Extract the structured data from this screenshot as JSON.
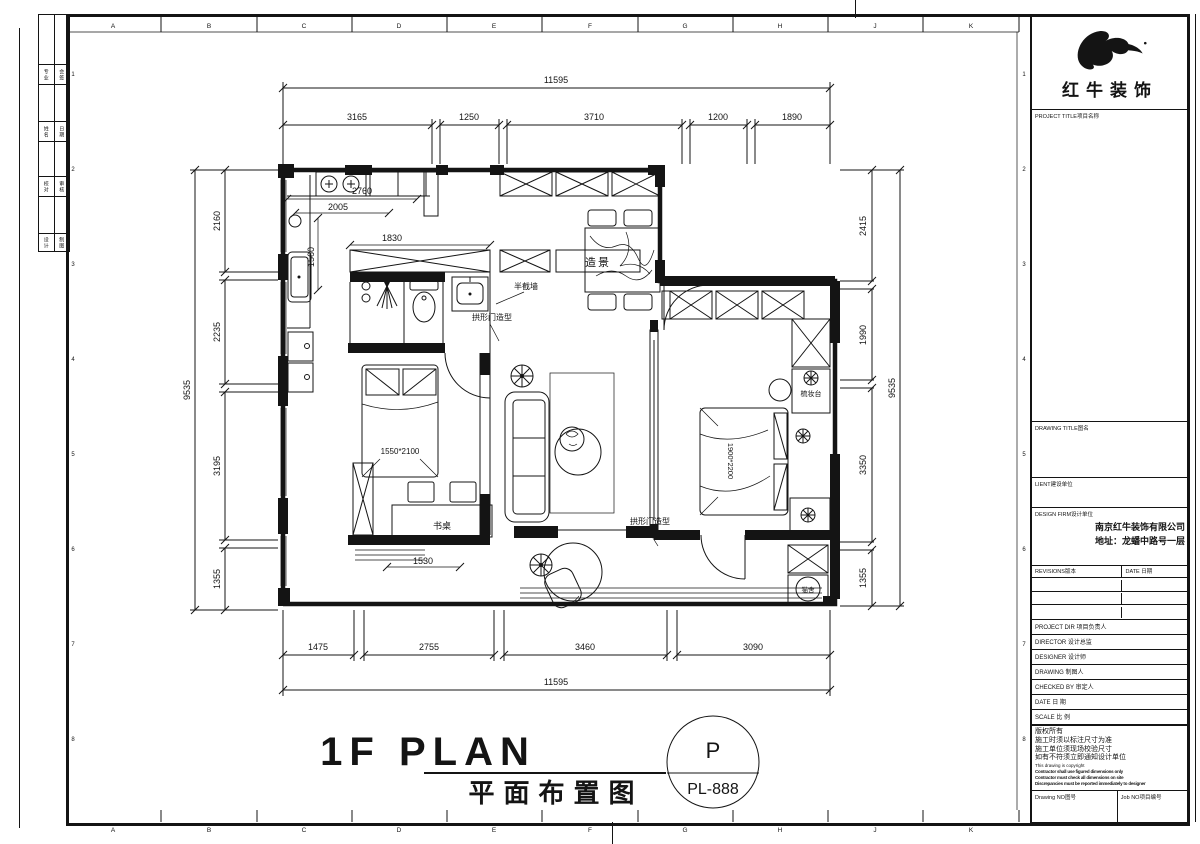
{
  "sheet": {
    "grid_letters": [
      "A",
      "B",
      "C",
      "D",
      "E",
      "F",
      "G",
      "H",
      "J",
      "K"
    ],
    "grid_numbers": [
      "1",
      "2",
      "3",
      "4",
      "5",
      "6",
      "7",
      "8"
    ],
    "strip": [
      "专业",
      "会签",
      "姓名",
      "日期",
      "校对",
      "审核",
      "设计",
      "制图"
    ]
  },
  "dims": {
    "top_total": "11595",
    "top": [
      "3165",
      "1250",
      "3710",
      "1200",
      "1890"
    ],
    "bottom": [
      "1475",
      "2755",
      "3460",
      "3090"
    ],
    "bottom_total": "11595",
    "left_total": "9535",
    "left": [
      "2160",
      "2235",
      "3195",
      "1355"
    ],
    "right": [
      "2415",
      "1990",
      "3350",
      "1355"
    ],
    "right_total": "9535",
    "d2760": "2760",
    "d2005": "2005",
    "d1560": "1560",
    "d1830": "1830",
    "d1530": "1530"
  },
  "labels": {
    "scenery": "造景",
    "half_wall": "半截墙",
    "arch1": "拱形门造型",
    "arch2": "拱形门造型",
    "bed_small": "1550*2100",
    "desk": "书桌",
    "bed_master": "1900*2200",
    "dresser": "梳妆台",
    "cat": "猫舍"
  },
  "title": {
    "en": "1F PLAN",
    "cn": "平面布置图",
    "stamp_letter": "P",
    "stamp_no": "PL-888"
  },
  "titleblock": {
    "brand": "红牛装饰",
    "project_title": "PROJECT TITLE项目名称",
    "drawing_title": "DRAWING TITLE图名",
    "client": "LIENT建设单位",
    "design_firm": "DESIGN FIRM设计单位",
    "firm_name": "南京红牛装饰有限公司",
    "firm_addr": "地址：龙蟠中路号一层",
    "revisions": "REVISIONS版本",
    "date_hdr": "DATE 日期",
    "rows": [
      "PROJECT DIR 项目负责人",
      "DIRECTOR 设计总监",
      "DESIGNER  设计师",
      "DRAWING   制图人",
      "CHECKED BY 审定人",
      "DATE      日 期",
      "SCALE     比 例"
    ],
    "copyright_cn": [
      "版权所有",
      "施工时须以标注尺寸为准",
      "施工单位须现场校验尺寸",
      "如有不符须立即通知设计单位"
    ],
    "copyright_en": [
      "This drawing is copyright",
      "Contractor shall use figured dimensions only",
      "Contractor must check all dimensions on site",
      "Discrepancies must be reported immediately to designer"
    ],
    "drawing_no": "Drawing NO图号",
    "job_no": "Job NO项目编号"
  }
}
